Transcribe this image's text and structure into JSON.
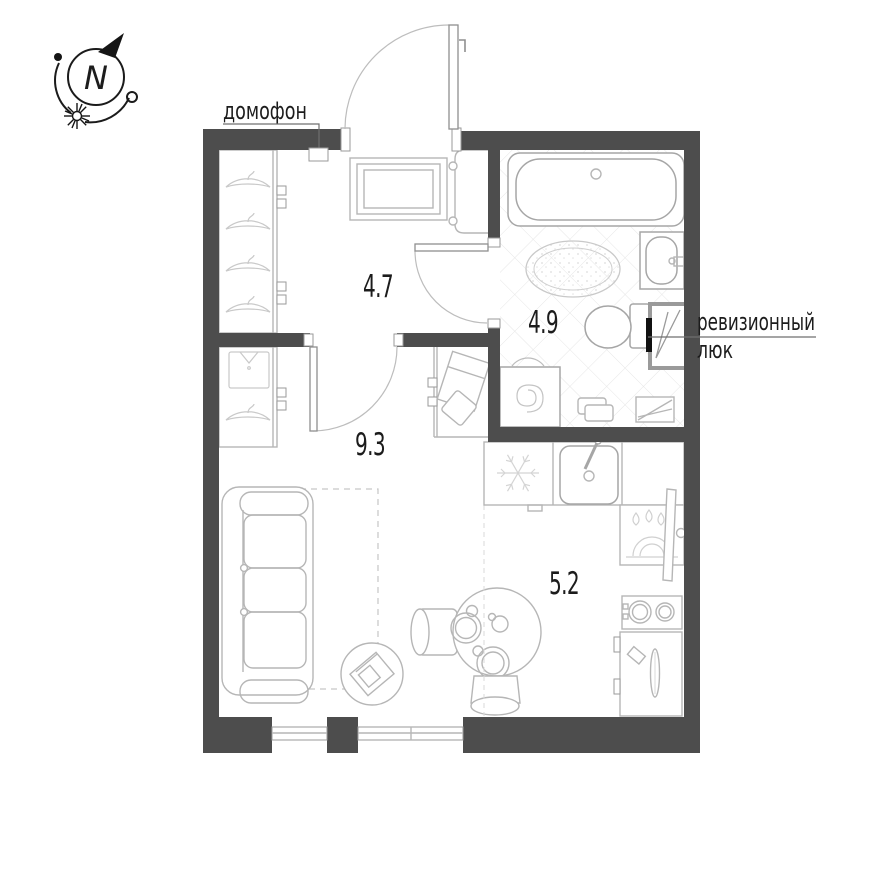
{
  "compass": {
    "north_letter": "N"
  },
  "annotations": {
    "intercom": "домофон",
    "hatch_line1": "ревизионный",
    "hatch_line2": "люк"
  },
  "rooms": {
    "hallway": {
      "area": "4.7"
    },
    "bathroom": {
      "area": "4.9"
    },
    "corridor": {
      "area": "9.3"
    },
    "kitchen": {
      "area": "5.2"
    }
  },
  "icons": [
    "compass-north-icon",
    "sun-icon",
    "coat-hanger-icon",
    "shirt-icon",
    "snowflake-icon",
    "water-drop-icon",
    "spiral-drum-icon"
  ],
  "colors": {
    "wall": "#4d4d4d",
    "furniture_line": "#b6b6b6",
    "tile_line": "#e6e6e6",
    "text": "#1c1c1c",
    "hatch_bar": "#111111"
  }
}
